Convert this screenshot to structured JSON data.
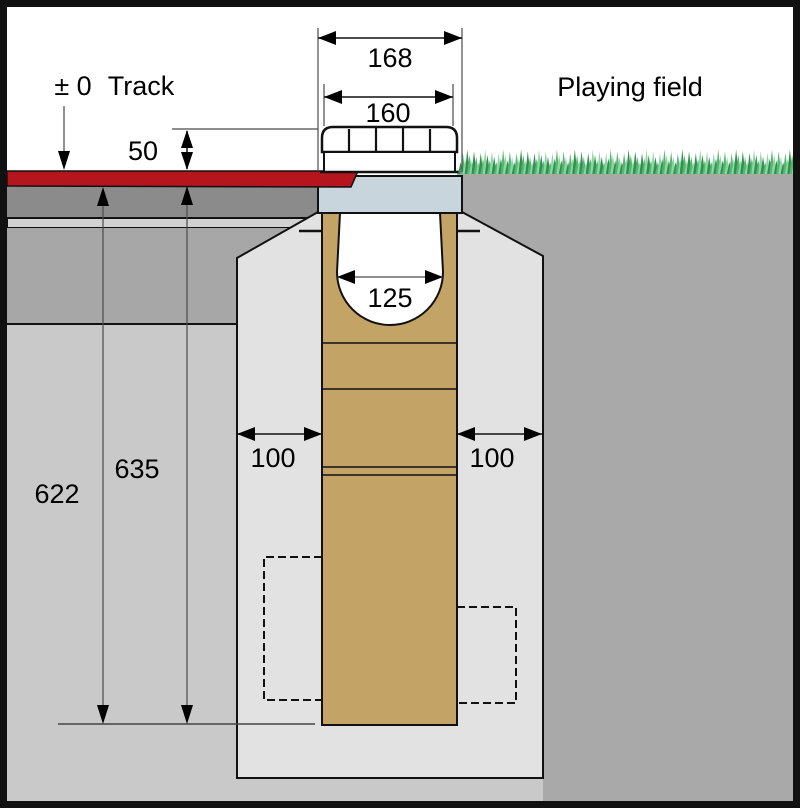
{
  "labels": {
    "datum": "± 0",
    "track": "Track",
    "playing_field": "Playing field"
  },
  "dimensions": {
    "cover_outer_width": "168",
    "cover_inner_width": "160",
    "cover_height_above_track": "50",
    "channel_inner_width": "125",
    "surround_left_width": "100",
    "surround_right_width": "100",
    "depth_left": "622",
    "depth_right": "635"
  },
  "colors": {
    "track_surface": "#b5151d",
    "base_layer_dark": "#8b8b8b",
    "base_layer_light": "#d2d2d2",
    "base_layer_mid": "#a7a7a7",
    "subsoil_left": "#c9c9c9",
    "subsoil_right": "#a9a9a9",
    "concrete_surround": "#e2e2e2",
    "channel_body": "#c3a366",
    "cover_seat": "#c9d5dc",
    "grass_dark": "#2f9150",
    "grass_mid": "#55b571",
    "grass_light": "#8fd3a2"
  }
}
